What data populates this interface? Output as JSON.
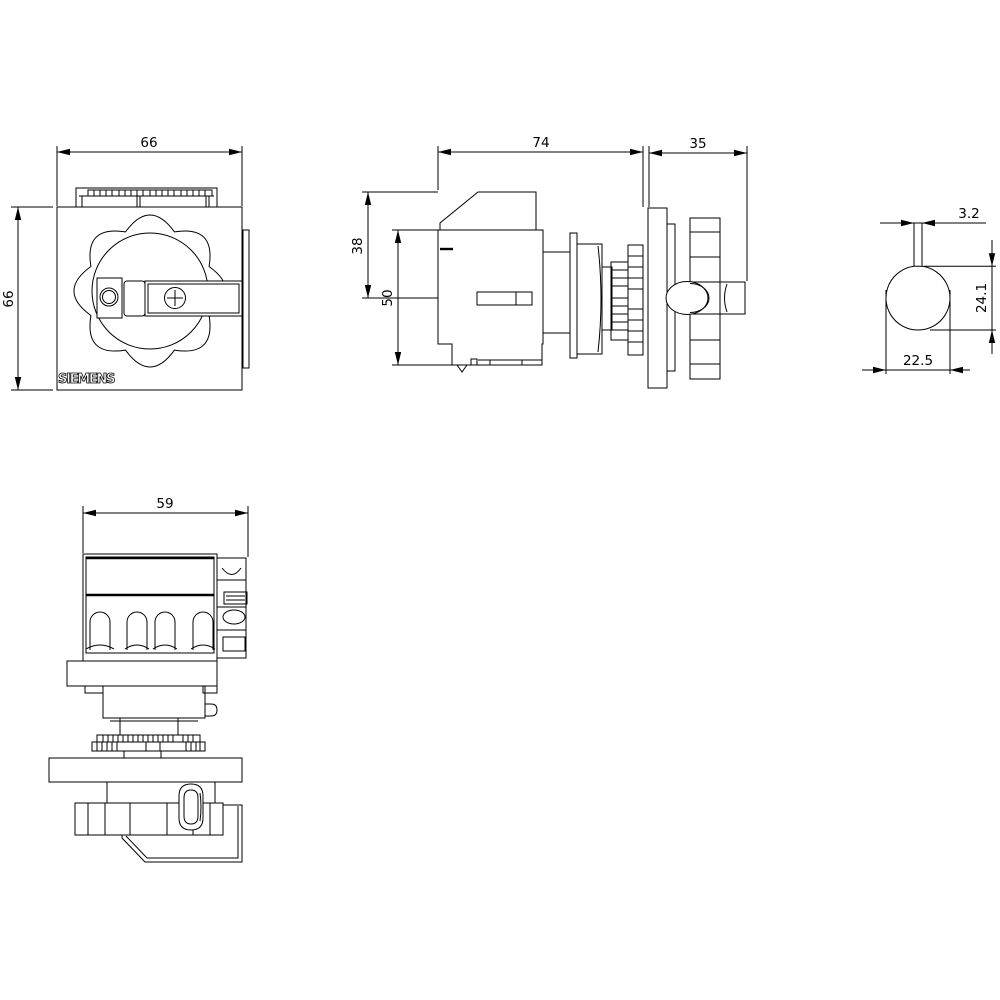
{
  "brand": "SIEMENS",
  "views": {
    "front": {
      "width": "66",
      "height": "66"
    },
    "side": {
      "depth_body": "74",
      "depth_handle": "35",
      "height_upper": "38",
      "height_total": "50"
    },
    "shaft_detail": {
      "slot_width": "3.2",
      "flat_height": "24.1",
      "width_across_flats": "22.5"
    },
    "bottom": {
      "width": "59"
    }
  }
}
